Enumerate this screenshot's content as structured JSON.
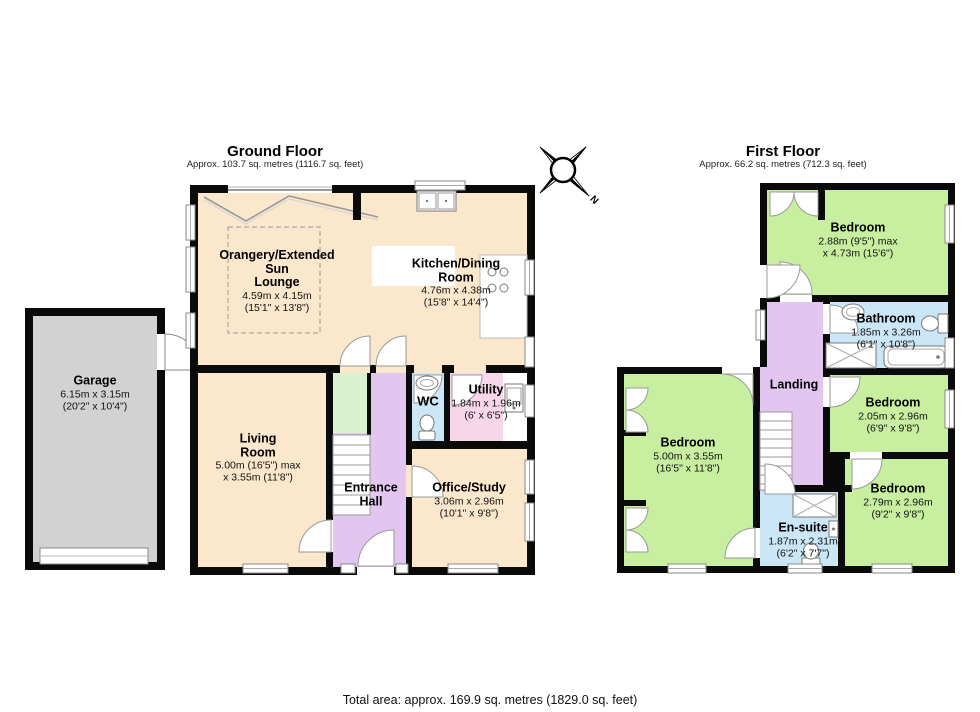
{
  "page": {
    "footer": "Total area: approx. 169.9 sq. metres (1829.0 sq. feet)",
    "compass_label": "N"
  },
  "colors": {
    "wall": "#0a0a0a",
    "cream": "#fae7cc",
    "green": "#c8ef9f",
    "pale_green": "#d9f2ce",
    "purple": "#e2c6ef",
    "blue": "#cbe6f6",
    "pink": "#f7d6e9",
    "garage_gray": "#d2d2d2"
  },
  "ground_floor": {
    "title": "Ground Floor",
    "subtitle": "Approx. 103.7 sq. metres (1116.7 sq. feet)",
    "rooms": {
      "garage": {
        "name": "Garage",
        "metric": "6.15m x 3.15m",
        "imperial": "(20'2\" x 10'4\")"
      },
      "orangery": {
        "name_line1": "Orangery/Extended",
        "name_line2": "Sun",
        "name_line3": "Lounge",
        "metric": "4.59m x 4.15m",
        "imperial": "(15'1\" x 13'8\")"
      },
      "kitchen": {
        "name_line1": "Kitchen/Dining",
        "name_line2": "Room",
        "metric": "4.76m x 4.38m",
        "imperial": "(15'8\" x 14'4\")"
      },
      "living": {
        "name_line1": "Living",
        "name_line2": "Room",
        "metric": "5.00m (16'5\") max",
        "imperial": "x 3.55m (11'8\")"
      },
      "wc": {
        "name": "WC"
      },
      "utility": {
        "name": "Utility",
        "metric": "1.84m x 1.96m",
        "imperial": "(6' x 6'5\")"
      },
      "entrance": {
        "name_line1": "Entrance",
        "name_line2": "Hall"
      },
      "office": {
        "name": "Office/Study",
        "metric": "3.06m x 2.96m",
        "imperial": "(10'1\" x 9'8\")"
      }
    }
  },
  "first_floor": {
    "title": "First Floor",
    "subtitle": "Approx. 66.2 sq. metres (712.3 sq. feet)",
    "rooms": {
      "bedroom_top": {
        "name": "Bedroom",
        "metric": "2.88m (9'5\") max",
        "imperial": "x 4.73m (15'6\")"
      },
      "bathroom": {
        "name": "Bathroom",
        "metric": "1.85m x 3.26m",
        "imperial": "(6'1\" x 10'8\")"
      },
      "landing": {
        "name": "Landing"
      },
      "bedroom_right": {
        "name": "Bedroom",
        "metric": "2.05m x 2.96m",
        "imperial": "(6'9\" x 9'8\")"
      },
      "bedroom_left": {
        "name": "Bedroom",
        "metric": "5.00m x 3.55m",
        "imperial": "(16'5\" x 11'8\")"
      },
      "bedroom_bottom": {
        "name": "Bedroom",
        "metric": "2.79m x 2.96m",
        "imperial": "(9'2\" x 9'8\")"
      },
      "ensuite": {
        "name": "En-suite",
        "metric": "1.87m x 2.31m",
        "imperial": "(6'2\" x 7'7\")"
      }
    }
  }
}
